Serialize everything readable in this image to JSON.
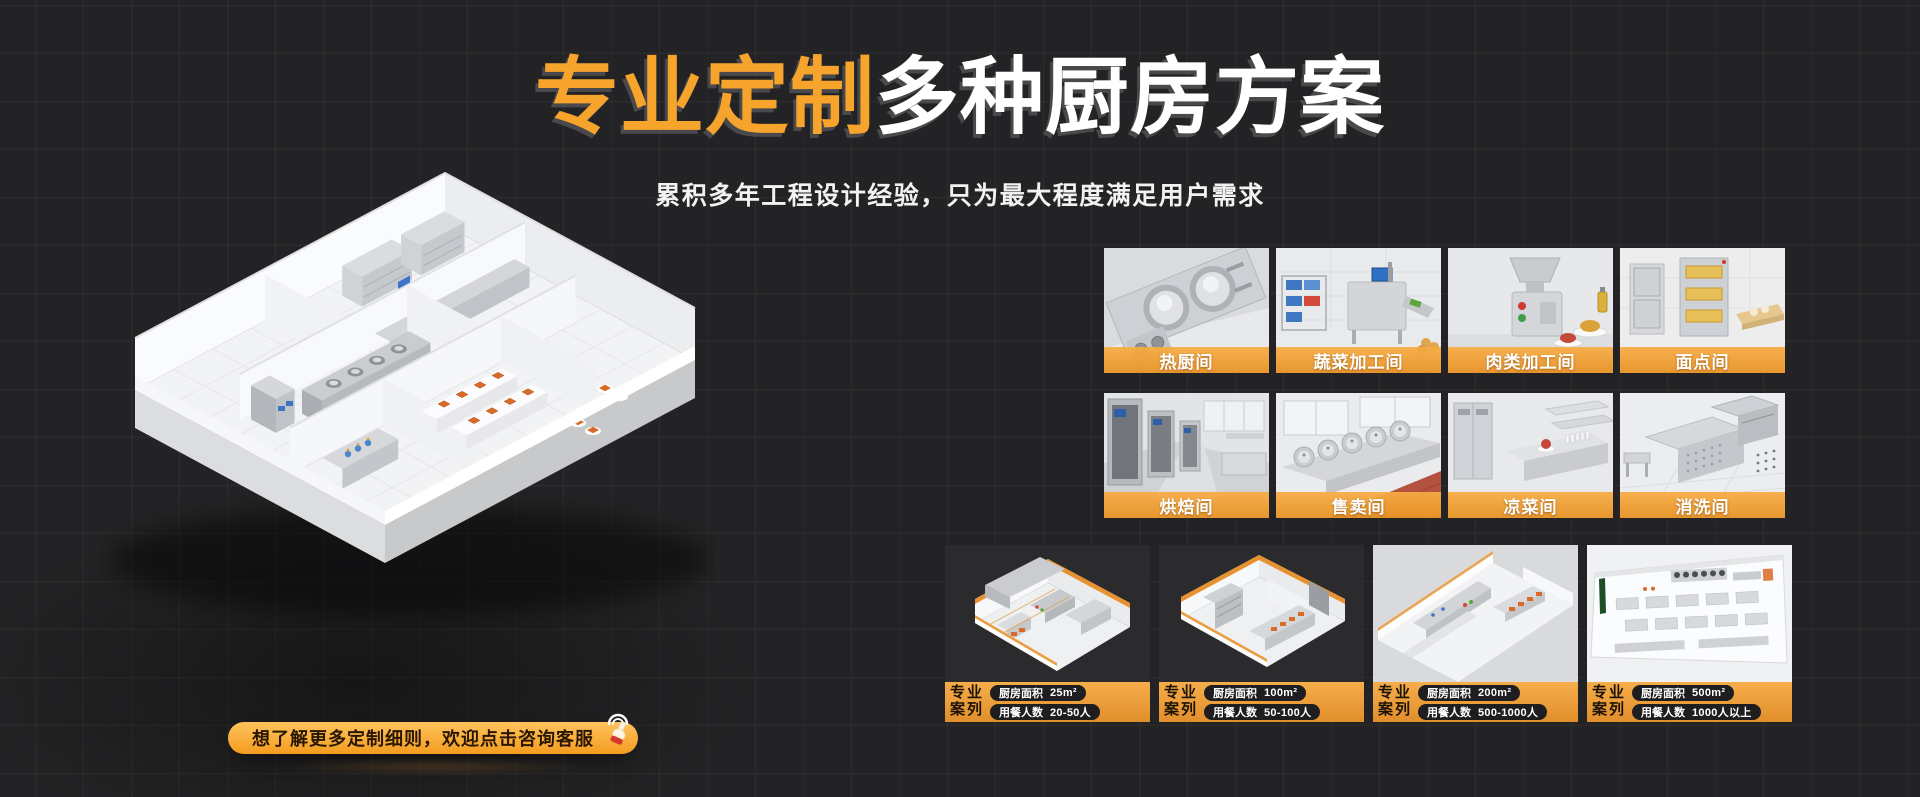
{
  "header": {
    "title_highlight": "专业定制",
    "title_rest": "多种厨房方案",
    "subtitle": "累积多年工程设计经验，只为最大程度满足用户需求"
  },
  "cta": {
    "label": "想了解更多定制细则，欢迎点击咨询客服",
    "icon": "tap-hand"
  },
  "room_tiles": [
    {
      "label": "热厨间"
    },
    {
      "label": "蔬菜加工间"
    },
    {
      "label": "肉类加工间"
    },
    {
      "label": "面点间"
    },
    {
      "label": "烘焙间"
    },
    {
      "label": "售卖间"
    },
    {
      "label": "凉菜间"
    },
    {
      "label": "消洗间"
    }
  ],
  "case_cards": [
    {
      "badge_top": "专业",
      "badge_bottom": "案列",
      "area_label": "厨房面积",
      "area_value": "25m²",
      "diners_label": "用餐人数",
      "diners_value": "20-50人"
    },
    {
      "badge_top": "专业",
      "badge_bottom": "案列",
      "area_label": "厨房面积",
      "area_value": "100m²",
      "diners_label": "用餐人数",
      "diners_value": "50-100人"
    },
    {
      "badge_top": "专业",
      "badge_bottom": "案列",
      "area_label": "厨房面积",
      "area_value": "200m²",
      "diners_label": "用餐人数",
      "diners_value": "500-1000人"
    },
    {
      "badge_top": "专业",
      "badge_bottom": "案列",
      "area_label": "厨房面积",
      "area_value": "500m²",
      "diners_label": "用餐人数",
      "diners_value": "1000人以上"
    }
  ],
  "colors": {
    "accent_orange": "#F6A42C",
    "background": "#232325",
    "label_bar_orange": "#EC9C3C",
    "case_footer_top": "#F6AE4A",
    "case_footer_bottom": "#E18E2C"
  }
}
